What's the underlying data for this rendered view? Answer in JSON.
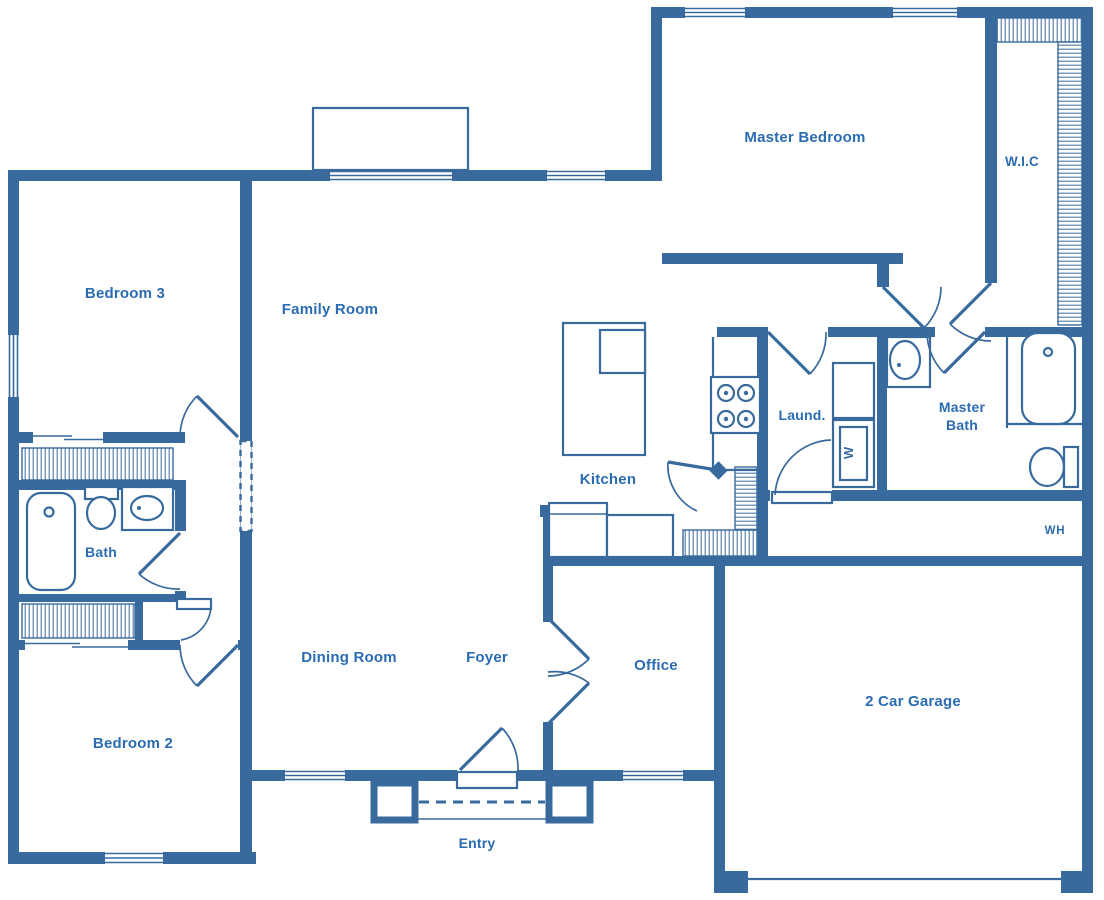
{
  "plan": {
    "rooms": [
      {
        "name": "master-bedroom",
        "label": "Master Bedroom"
      },
      {
        "name": "walk-in-closet",
        "label": "W.I.C"
      },
      {
        "name": "bedroom-3",
        "label": "Bedroom 3"
      },
      {
        "name": "family-room",
        "label": "Family Room"
      },
      {
        "name": "kitchen",
        "label": "Kitchen"
      },
      {
        "name": "laundry",
        "label": "Laund."
      },
      {
        "name": "master-bath-line-1",
        "label": "Master"
      },
      {
        "name": "master-bath-line-2",
        "label": "Bath"
      },
      {
        "name": "bath",
        "label": "Bath"
      },
      {
        "name": "water-heater",
        "label": "WH"
      },
      {
        "name": "dining-room",
        "label": "Dining Room"
      },
      {
        "name": "foyer",
        "label": "Foyer"
      },
      {
        "name": "office",
        "label": "Office"
      },
      {
        "name": "bedroom-2",
        "label": "Bedroom 2"
      },
      {
        "name": "garage",
        "label": "2 Car Garage"
      },
      {
        "name": "entry",
        "label": "Entry"
      }
    ],
    "appliances": {
      "washer_label": "W"
    },
    "colors": {
      "wall": "#386a9d",
      "label_text": "#2b6cb0",
      "background": "#ffffff"
    }
  }
}
